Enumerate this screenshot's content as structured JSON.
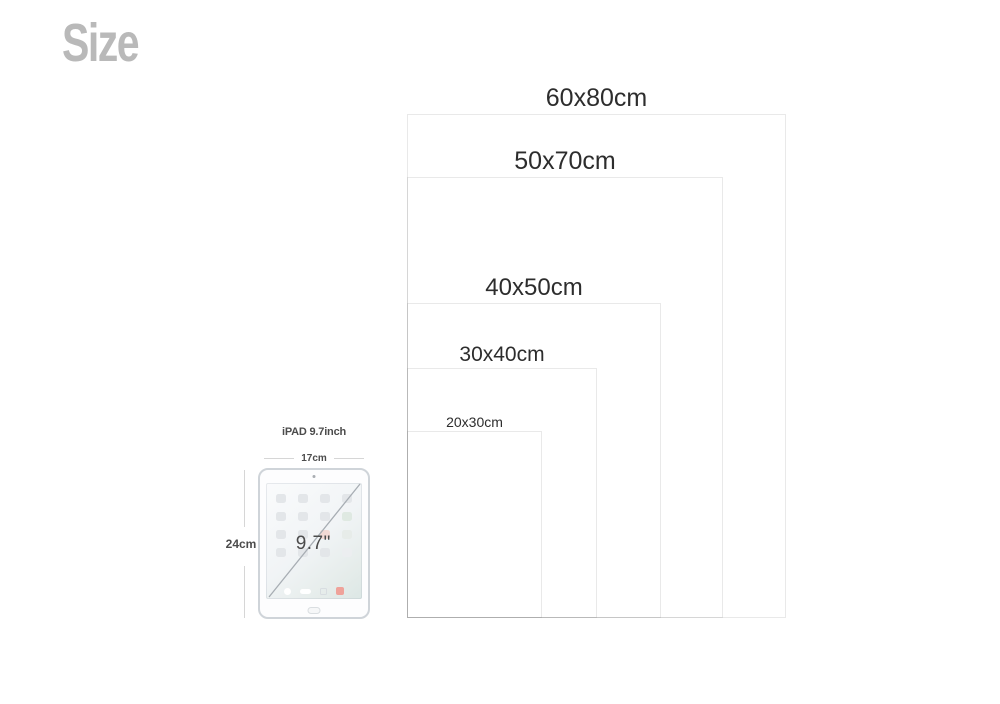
{
  "title": "Size",
  "diagram": {
    "sizes": [
      {
        "label": "60x80cm"
      },
      {
        "label": "50x70cm"
      },
      {
        "label": "40x50cm"
      },
      {
        "label": "30x40cm"
      },
      {
        "label": "20x30cm"
      }
    ],
    "ipad": {
      "name": "iPAD 9.7inch",
      "width_label": "17cm",
      "height_label": "24cm",
      "diagonal_label": "9.7\""
    }
  },
  "colors": {
    "title_gray": "#b9b9b9",
    "label_text": "#2d2d2d",
    "rect_border_light": "#e9e9e9",
    "rect_border_overlapped": "#b0b0b0",
    "dimension_line": "#d6d6d6",
    "ipad_border": "#cfd4d9",
    "dock_red_icon": "#efa29a"
  }
}
